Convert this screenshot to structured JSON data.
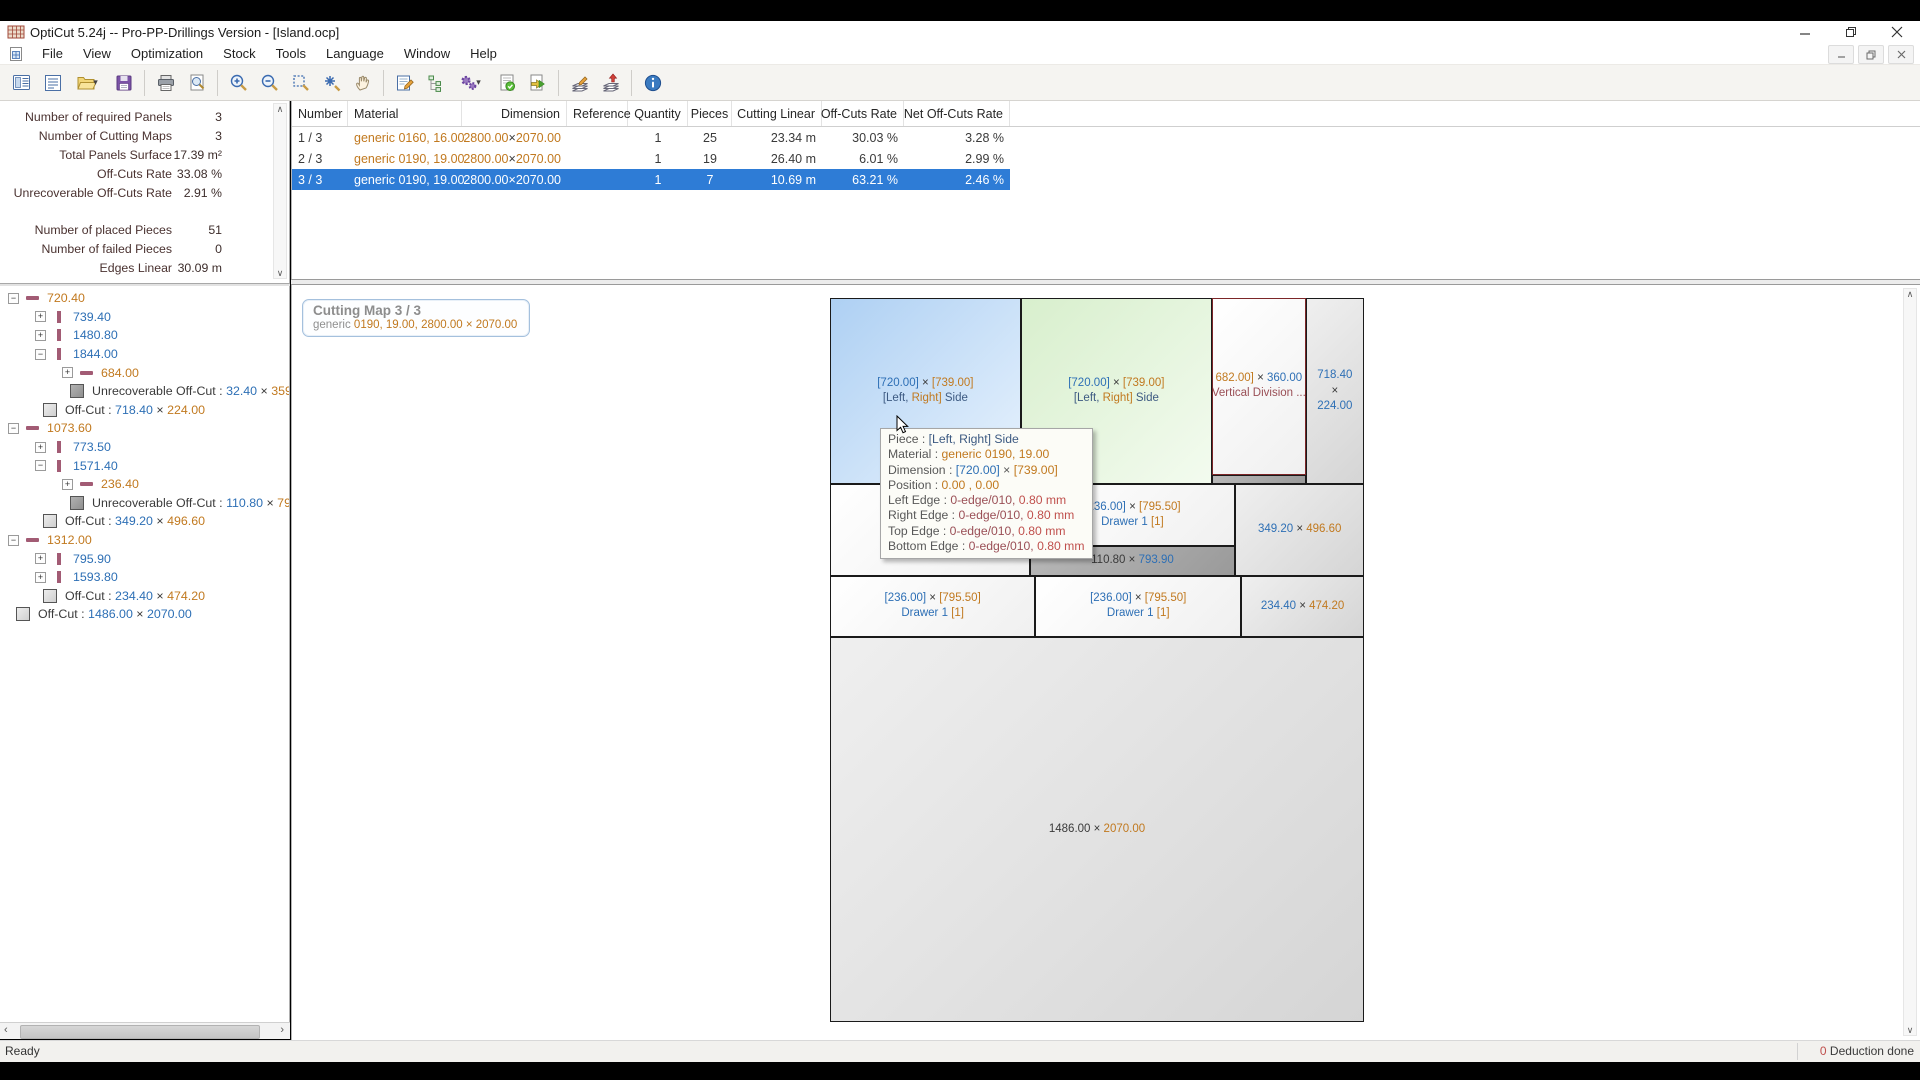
{
  "window": {
    "title": "OptiCut 5.24j -- Pro-PP-Drillings Version - [Island.ocp]",
    "controls": [
      "minimize",
      "restore",
      "close"
    ],
    "mdi_controls": [
      "minimize",
      "restore",
      "close"
    ]
  },
  "menu": {
    "items": [
      "File",
      "View",
      "Optimization",
      "Stock",
      "Tools",
      "Language",
      "Window",
      "Help"
    ]
  },
  "toolbar": {
    "icons": [
      "report",
      "print-list",
      "open",
      "save",
      "print",
      "print-preview",
      "zoom-in",
      "zoom-out",
      "zoom-window",
      "zoom-fit",
      "pan",
      "edit-pieces",
      "optimization-parameters",
      "settings",
      "validate",
      "export",
      "edges-edit",
      "edges-apply",
      "info"
    ]
  },
  "stats": {
    "groups": [
      [
        {
          "label": "Number of required Panels",
          "value": "3"
        },
        {
          "label": "Number of Cutting Maps",
          "value": "3"
        },
        {
          "label": "Total Panels Surface",
          "value": "17.39 m²"
        },
        {
          "label": "Off-Cuts Rate",
          "value": "33.08 %"
        },
        {
          "label": "Unrecoverable Off-Cuts Rate",
          "value": "2.91 %"
        }
      ],
      [
        {
          "label": "Number of placed Pieces",
          "value": "51"
        },
        {
          "label": "Number of failed Pieces",
          "value": "0"
        },
        {
          "label": "Edges Linear",
          "value": "30.09 m"
        }
      ]
    ]
  },
  "tree": {
    "items": [
      {
        "lvl": 0,
        "exp": "minus",
        "icon": "hbar",
        "segs": [
          {
            "t": "720.40",
            "c": "orange"
          }
        ]
      },
      {
        "lvl": 1,
        "exp": "plus",
        "icon": "vbar",
        "segs": [
          {
            "t": "739.40",
            "c": "blue"
          }
        ]
      },
      {
        "lvl": 1,
        "exp": "plus",
        "icon": "vbar",
        "segs": [
          {
            "t": "1480.80",
            "c": "blue"
          }
        ]
      },
      {
        "lvl": 1,
        "exp": "minus",
        "icon": "vbar",
        "segs": [
          {
            "t": "1844.00",
            "c": "blue"
          }
        ]
      },
      {
        "lvl": 2,
        "exp": "plus",
        "icon": "hbar",
        "segs": [
          {
            "t": "684.00",
            "c": "orange"
          }
        ]
      },
      {
        "lvl": 2,
        "exp": null,
        "icon": "sqd",
        "segs": [
          {
            "t": "Unrecoverable Off-Cut : ",
            "c": "dark"
          },
          {
            "t": "32.40",
            "c": "blue"
          },
          {
            "t": " × ",
            "c": "dark"
          },
          {
            "t": "359.20",
            "c": "orange"
          }
        ]
      },
      {
        "lvl": 1,
        "exp": null,
        "icon": "sq",
        "segs": [
          {
            "t": "Off-Cut : ",
            "c": "dark"
          },
          {
            "t": "718.40",
            "c": "blue"
          },
          {
            "t": " × ",
            "c": "dark"
          },
          {
            "t": "224.00",
            "c": "orange"
          }
        ]
      },
      {
        "lvl": 0,
        "exp": "minus",
        "icon": "hbar",
        "segs": [
          {
            "t": "1073.60",
            "c": "orange"
          }
        ]
      },
      {
        "lvl": 1,
        "exp": "plus",
        "icon": "vbar",
        "segs": [
          {
            "t": "773.50",
            "c": "blue"
          }
        ]
      },
      {
        "lvl": 1,
        "exp": "minus",
        "icon": "vbar",
        "segs": [
          {
            "t": "1571.40",
            "c": "blue"
          }
        ]
      },
      {
        "lvl": 2,
        "exp": "plus",
        "icon": "hbar",
        "segs": [
          {
            "t": "236.40",
            "c": "orange"
          }
        ]
      },
      {
        "lvl": 2,
        "exp": null,
        "icon": "sqd",
        "segs": [
          {
            "t": "Unrecoverable Off-Cut : ",
            "c": "dark"
          },
          {
            "t": "110.80",
            "c": "blue"
          },
          {
            "t": " × ",
            "c": "dark"
          },
          {
            "t": "793.9",
            "c": "orange"
          }
        ]
      },
      {
        "lvl": 1,
        "exp": null,
        "icon": "sq",
        "segs": [
          {
            "t": "Off-Cut : ",
            "c": "dark"
          },
          {
            "t": "349.20",
            "c": "blue"
          },
          {
            "t": " × ",
            "c": "dark"
          },
          {
            "t": "496.60",
            "c": "orange"
          }
        ]
      },
      {
        "lvl": 0,
        "exp": "minus",
        "icon": "hbar",
        "segs": [
          {
            "t": "1312.00",
            "c": "orange"
          }
        ]
      },
      {
        "lvl": 1,
        "exp": "plus",
        "icon": "vbar",
        "segs": [
          {
            "t": "795.90",
            "c": "blue"
          }
        ]
      },
      {
        "lvl": 1,
        "exp": "plus",
        "icon": "vbar",
        "segs": [
          {
            "t": "1593.80",
            "c": "blue"
          }
        ]
      },
      {
        "lvl": 1,
        "exp": null,
        "icon": "sq",
        "segs": [
          {
            "t": "Off-Cut : ",
            "c": "dark"
          },
          {
            "t": "234.40",
            "c": "blue"
          },
          {
            "t": " × ",
            "c": "dark"
          },
          {
            "t": "474.20",
            "c": "orange"
          }
        ]
      },
      {
        "lvl": 0,
        "exp": null,
        "icon": "sq",
        "segs": [
          {
            "t": "Off-Cut : ",
            "c": "dark"
          },
          {
            "t": "1486.00",
            "c": "blue"
          },
          {
            "t": " × ",
            "c": "dark"
          },
          {
            "t": "2070.00",
            "c": "blue"
          }
        ]
      }
    ]
  },
  "table": {
    "columns": [
      {
        "label": "Number",
        "w": 56,
        "align": "left"
      },
      {
        "label": "Material",
        "w": 114,
        "align": "left"
      },
      {
        "label": "Dimension",
        "w": 105,
        "align": "right"
      },
      {
        "label": "Reference",
        "w": 61,
        "align": "left"
      },
      {
        "label": "Quantity",
        "w": 60,
        "align": "center"
      },
      {
        "label": "Pieces",
        "w": 44,
        "align": "center"
      },
      {
        "label": "Cutting Linear",
        "w": 90,
        "align": "right"
      },
      {
        "label": "Off-Cuts Rate",
        "w": 82,
        "align": "right"
      },
      {
        "label": "Net Off-Cuts Rate",
        "w": 106,
        "align": "right"
      }
    ],
    "rows": [
      {
        "selected": false,
        "cells": [
          [
            {
              "t": "1 / 3",
              "c": "dark"
            }
          ],
          [
            {
              "t": "generic 0160, 16.00",
              "c": "orange"
            }
          ],
          [
            {
              "t": "2800.00",
              "c": "orange"
            },
            {
              "t": " × ",
              "c": "dark"
            },
            {
              "t": "2070.00",
              "c": "orange"
            }
          ],
          [],
          [
            {
              "t": "1",
              "c": "dark"
            }
          ],
          [
            {
              "t": "25",
              "c": "dark"
            }
          ],
          [
            {
              "t": "23.34 m",
              "c": "dark"
            }
          ],
          [
            {
              "t": "30.03 %",
              "c": "dark"
            }
          ],
          [
            {
              "t": "3.28 %",
              "c": "dark"
            }
          ]
        ]
      },
      {
        "selected": false,
        "cells": [
          [
            {
              "t": "2 / 3",
              "c": "dark"
            }
          ],
          [
            {
              "t": "generic 0190, 19.00",
              "c": "orange"
            }
          ],
          [
            {
              "t": "2800.00",
              "c": "orange"
            },
            {
              "t": " × ",
              "c": "dark"
            },
            {
              "t": "2070.00",
              "c": "orange"
            }
          ],
          [],
          [
            {
              "t": "1",
              "c": "dark"
            }
          ],
          [
            {
              "t": "19",
              "c": "dark"
            }
          ],
          [
            {
              "t": "26.40 m",
              "c": "dark"
            }
          ],
          [
            {
              "t": "6.01 %",
              "c": "dark"
            }
          ],
          [
            {
              "t": "2.99 %",
              "c": "dark"
            }
          ]
        ]
      },
      {
        "selected": true,
        "cells": [
          [
            {
              "t": "3 / 3",
              "c": "dark"
            }
          ],
          [
            {
              "t": "generic 0190, 19.00",
              "c": "orange"
            }
          ],
          [
            {
              "t": "2800.00",
              "c": "orange"
            },
            {
              "t": " × ",
              "c": "dark"
            },
            {
              "t": "2070.00",
              "c": "orange"
            }
          ],
          [],
          [
            {
              "t": "1",
              "c": "dark"
            }
          ],
          [
            {
              "t": "7",
              "c": "dark"
            }
          ],
          [
            {
              "t": "10.69 m",
              "c": "dark"
            }
          ],
          [
            {
              "t": "63.21 %",
              "c": "dark"
            }
          ],
          [
            {
              "t": "2.46 %",
              "c": "dark"
            }
          ]
        ]
      }
    ]
  },
  "map": {
    "header": {
      "title": "Cutting Map 3 / 3",
      "subtitle": [
        {
          "t": "generic ",
          "c": "gray"
        },
        {
          "t": "0190, 19.00, 2800.00 × 2070.00",
          "c": "orange"
        }
      ]
    },
    "panel": {
      "width_mm": 2070,
      "height_mm": 2800
    },
    "pieces": [
      {
        "x": 0,
        "y": 0,
        "w": 739.4,
        "h": 720.4,
        "type": "blue",
        "lines": [
          [
            {
              "t": "[720.00]",
              "c": "blue"
            },
            {
              "t": " × ",
              "c": "dark"
            },
            {
              "t": "[739.00]",
              "c": "orange"
            }
          ],
          [
            {
              "t": "[Left,",
              "c": "navy"
            },
            {
              "t": " Right]",
              "c": "orange"
            },
            {
              "t": " Side",
              "c": "navy"
            }
          ]
        ]
      },
      {
        "x": 739.4,
        "y": 0,
        "w": 741.4,
        "h": 720.4,
        "type": "green",
        "lines": [
          [
            {
              "t": "[720.00]",
              "c": "blue"
            },
            {
              "t": " × ",
              "c": "dark"
            },
            {
              "t": "[739.00]",
              "c": "orange"
            }
          ],
          [
            {
              "t": "[Left,",
              "c": "navy"
            },
            {
              "t": " Right]",
              "c": "orange"
            },
            {
              "t": " Side",
              "c": "navy"
            }
          ]
        ]
      },
      {
        "x": 1480.8,
        "y": 0,
        "w": 363.2,
        "h": 684,
        "type": "white",
        "red": true,
        "lines": [
          [
            {
              "t": "682.00]",
              "c": "orange"
            },
            {
              "t": " × ",
              "c": "dark"
            },
            {
              "t": "360.00",
              "c": "blue"
            }
          ],
          [
            {
              "t": "Vertical Division ...",
              "c": "maroon"
            }
          ]
        ]
      },
      {
        "x": 1480.8,
        "y": 684,
        "w": 363.2,
        "h": 36.4,
        "type": "offdark",
        "lines": []
      },
      {
        "x": 1844,
        "y": 0,
        "w": 226,
        "h": 720.4,
        "type": "off",
        "lines": [
          [
            {
              "t": "718.40",
              "c": "blue"
            }
          ],
          [
            {
              "t": "×",
              "c": "dark"
            }
          ],
          [
            {
              "t": "224.00",
              "c": "blue"
            }
          ]
        ]
      },
      {
        "x": 0,
        "y": 720.4,
        "w": 773.5,
        "h": 353.2,
        "type": "white",
        "lines": []
      },
      {
        "x": 773.5,
        "y": 720.4,
        "w": 797.9,
        "h": 239,
        "type": "white",
        "lines": [
          [
            {
              "t": "[236.00]",
              "c": "blue"
            },
            {
              "t": " × ",
              "c": "dark"
            },
            {
              "t": "[795.50]",
              "c": "orange"
            }
          ],
          [
            {
              "t": "Drawer 1 ",
              "c": "blue"
            },
            {
              "t": "[1]",
              "c": "orange"
            }
          ]
        ]
      },
      {
        "x": 773.5,
        "y": 959.4,
        "w": 797.9,
        "h": 114.2,
        "type": "offdark",
        "lines": [
          [
            {
              "t": "110.80",
              "c": "dark"
            },
            {
              "t": " × ",
              "c": "dark"
            },
            {
              "t": "793.90",
              "c": "blue"
            }
          ]
        ]
      },
      {
        "x": 1571.4,
        "y": 720.4,
        "w": 498.6,
        "h": 353.2,
        "type": "off",
        "lines": [
          [
            {
              "t": "349.20",
              "c": "blue"
            },
            {
              "t": " × ",
              "c": "dark"
            },
            {
              "t": "496.60",
              "c": "orange"
            }
          ]
        ]
      },
      {
        "x": 0,
        "y": 1073.6,
        "w": 795.9,
        "h": 238.4,
        "type": "white",
        "lines": [
          [
            {
              "t": "[236.00]",
              "c": "blue"
            },
            {
              "t": " × ",
              "c": "dark"
            },
            {
              "t": "[795.50]",
              "c": "orange"
            }
          ],
          [
            {
              "t": "Drawer 1 ",
              "c": "blue"
            },
            {
              "t": "[1]",
              "c": "orange"
            }
          ]
        ]
      },
      {
        "x": 795.9,
        "y": 1073.6,
        "w": 797.9,
        "h": 238.4,
        "type": "white",
        "lines": [
          [
            {
              "t": "[236.00]",
              "c": "blue"
            },
            {
              "t": " × ",
              "c": "dark"
            },
            {
              "t": "[795.50]",
              "c": "orange"
            }
          ],
          [
            {
              "t": "Drawer 1 ",
              "c": "blue"
            },
            {
              "t": "[1]",
              "c": "orange"
            }
          ]
        ]
      },
      {
        "x": 1593.8,
        "y": 1073.6,
        "w": 476.2,
        "h": 238.4,
        "type": "off",
        "lines": [
          [
            {
              "t": "234.40",
              "c": "blue"
            },
            {
              "t": " × ",
              "c": "dark"
            },
            {
              "t": "474.20",
              "c": "orange"
            }
          ]
        ]
      },
      {
        "x": 0,
        "y": 1312,
        "w": 2070,
        "h": 1488,
        "type": "off",
        "lines": [
          [
            {
              "t": "1486.00",
              "c": "dark"
            },
            {
              "t": " × ",
              "c": "dark"
            },
            {
              "t": "2070.00",
              "c": "orange"
            }
          ]
        ]
      }
    ],
    "tooltip": {
      "lines": [
        [
          {
            "t": "Piece : ",
            "c": "label"
          },
          {
            "t": "[Left, Right] Side",
            "c": "navy"
          }
        ],
        [
          {
            "t": "Material : ",
            "c": "label"
          },
          {
            "t": "generic 0190, 19.00",
            "c": "orange"
          }
        ],
        [
          {
            "t": "Dimension : ",
            "c": "label"
          },
          {
            "t": "[720.00]",
            "c": "blue"
          },
          {
            "t": " × ",
            "c": "label"
          },
          {
            "t": "[739.00]",
            "c": "orange"
          }
        ],
        [
          {
            "t": "Position : ",
            "c": "label"
          },
          {
            "t": "0.00 , 0.00",
            "c": "orange"
          }
        ],
        [
          {
            "t": "Left Edge : ",
            "c": "label"
          },
          {
            "t": "0-edge/010,",
            "c": "maroon"
          },
          {
            "t": "  0.80 mm",
            "c": "red"
          }
        ],
        [
          {
            "t": "Right Edge : ",
            "c": "label"
          },
          {
            "t": "0-edge/010,",
            "c": "maroon"
          },
          {
            "t": "  0.80 mm",
            "c": "red"
          }
        ],
        [
          {
            "t": "Top Edge : ",
            "c": "label"
          },
          {
            "t": "0-edge/010,",
            "c": "maroon"
          },
          {
            "t": "  0.80 mm",
            "c": "red"
          }
        ],
        [
          {
            "t": "Bottom Edge : ",
            "c": "label"
          },
          {
            "t": "0-edge/010,",
            "c": "maroon"
          },
          {
            "t": "  0.80 mm",
            "c": "red"
          }
        ]
      ]
    }
  },
  "status_bar": {
    "left": "Ready",
    "right": [
      {
        "t": "0",
        "c": "red"
      },
      {
        "t": " Deduction done",
        "c": "dark"
      }
    ]
  },
  "colors": {
    "selection": "#2e7cd6",
    "piece_blue": "#aed0f3",
    "piece_green": "#d8efcd",
    "offcut": "#d5d5d5",
    "offcut_unrecoverable": "#9a9a9a",
    "tree_bar": "#a25b74",
    "value_width": "#2d6fb5",
    "value_height": "#c1791f"
  }
}
